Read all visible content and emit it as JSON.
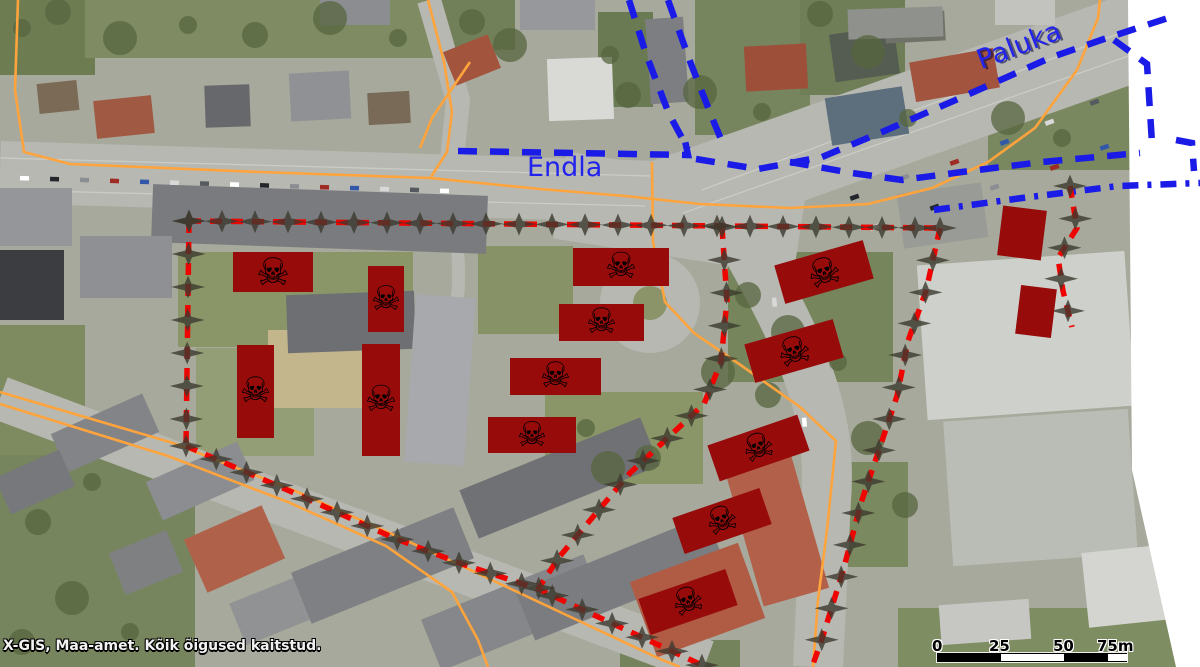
{
  "attribution": "X-GIS, Maa-amet. Kõik õigused kaitstud.",
  "street_labels": [
    {
      "id": "endla",
      "text": "Endla",
      "x": 527,
      "y": 152,
      "rotation": 0,
      "size": 27
    },
    {
      "id": "paluka",
      "text": "Paluka",
      "x": 978,
      "y": 46,
      "rotation": -21,
      "size": 27
    }
  ],
  "scale_bar": {
    "labels": [
      "0",
      "25",
      "50",
      "75m"
    ],
    "label_offsets": [
      -5,
      52,
      116,
      160
    ],
    "x": 937,
    "y": 637,
    "width": 190,
    "segments": [
      {
        "from": 0,
        "to": 63,
        "color": "#000000"
      },
      {
        "from": 63,
        "to": 126,
        "color": "#ffffff"
      },
      {
        "from": 126,
        "to": 170,
        "color": "#000000"
      },
      {
        "from": 170,
        "to": 190,
        "color": "#ffffff"
      }
    ]
  },
  "colors": {
    "hazard_fill": "#970b0b",
    "boundary_red": "#ee0400",
    "cadastre_blue": "#1b1be8",
    "road_orange": "#ffa43d",
    "star_marker": "#3c3a2e",
    "label_blue": "#2323ee",
    "no_imagery": "#ffffff"
  },
  "icons": {
    "skull_glyph": "☠",
    "skull_name": "skull-crossbones-icon",
    "vertex_marker": "four-point-star"
  },
  "hazard_rects": [
    {
      "x": 233,
      "y": 252,
      "w": 80,
      "h": 40,
      "rotation": 0,
      "skull": true
    },
    {
      "x": 368,
      "y": 266,
      "w": 36,
      "h": 66,
      "rotation": 0,
      "skull": true
    },
    {
      "x": 237,
      "y": 345,
      "w": 37,
      "h": 93,
      "rotation": 0,
      "skull": true
    },
    {
      "x": 362,
      "y": 344,
      "w": 38,
      "h": 112,
      "rotation": 0,
      "skull": true
    },
    {
      "x": 573,
      "y": 248,
      "w": 96,
      "h": 38,
      "rotation": 0,
      "skull": true
    },
    {
      "x": 559,
      "y": 304,
      "w": 85,
      "h": 37,
      "rotation": 0,
      "skull": true
    },
    {
      "x": 510,
      "y": 358,
      "w": 91,
      "h": 37,
      "rotation": 0,
      "skull": true
    },
    {
      "x": 488,
      "y": 417,
      "w": 88,
      "h": 36,
      "rotation": 0,
      "skull": true
    },
    {
      "x": 778,
      "y": 252,
      "w": 92,
      "h": 40,
      "rotation": -16,
      "skull": true
    },
    {
      "x": 748,
      "y": 331,
      "w": 92,
      "h": 40,
      "rotation": -16,
      "skull": true
    },
    {
      "x": 711,
      "y": 429,
      "w": 95,
      "h": 38,
      "rotation": -19,
      "skull": true
    },
    {
      "x": 676,
      "y": 502,
      "w": 92,
      "h": 38,
      "rotation": -19,
      "skull": true
    },
    {
      "x": 642,
      "y": 583,
      "w": 92,
      "h": 38,
      "rotation": -19,
      "skull": true
    },
    {
      "x": 1000,
      "y": 208,
      "w": 44,
      "h": 50,
      "rotation": 7,
      "skull": false
    },
    {
      "x": 1018,
      "y": 287,
      "w": 36,
      "h": 49,
      "rotation": 7,
      "skull": false
    }
  ],
  "red_lines": [
    {
      "points": [
        [
          189,
          221
        ],
        [
          940,
          228
        ]
      ]
    },
    {
      "points": [
        [
          189,
          221
        ],
        [
          186,
          446
        ]
      ]
    },
    {
      "points": [
        [
          186,
          446
        ],
        [
          292,
          492
        ],
        [
          394,
          538
        ],
        [
          462,
          564
        ],
        [
          538,
          589
        ],
        [
          622,
          628
        ],
        [
          706,
          667
        ]
      ]
    },
    {
      "points": [
        [
          940,
          228
        ],
        [
          926,
          291
        ],
        [
          908,
          341
        ],
        [
          897,
          396
        ],
        [
          882,
          441
        ],
        [
          861,
          503
        ],
        [
          843,
          571
        ],
        [
          822,
          639
        ],
        [
          812,
          667
        ]
      ]
    },
    {
      "points": [
        [
          722,
          227
        ],
        [
          727,
          300
        ],
        [
          721,
          362
        ],
        [
          704,
          404
        ],
        [
          630,
          473
        ],
        [
          560,
          556
        ],
        [
          538,
          589
        ]
      ]
    },
    {
      "points": [
        [
          1070,
          186
        ],
        [
          1077,
          228
        ],
        [
          1058,
          258
        ],
        [
          1063,
          291
        ],
        [
          1072,
          327
        ]
      ]
    }
  ],
  "blue_lines": [
    {
      "style": "dash",
      "points": [
        [
          458,
          151
        ],
        [
          688,
          155
        ],
        [
          684,
          136
        ]
      ]
    },
    {
      "style": "dash",
      "points": [
        [
          629,
          0
        ],
        [
          646,
          54
        ],
        [
          669,
          114
        ],
        [
          688,
          149
        ]
      ]
    },
    {
      "style": "dash",
      "points": [
        [
          668,
          0
        ],
        [
          691,
          64
        ],
        [
          713,
          120
        ],
        [
          723,
          144
        ]
      ]
    },
    {
      "style": "dash",
      "points": [
        [
          696,
          159
        ],
        [
          758,
          169
        ],
        [
          822,
          157
        ],
        [
          882,
          132
        ],
        [
          958,
          99
        ],
        [
          1052,
          57
        ],
        [
          1104,
          39
        ],
        [
          1168,
          18
        ]
      ]
    },
    {
      "style": "dash",
      "points": [
        [
          790,
          162
        ],
        [
          852,
          173
        ],
        [
          902,
          180
        ],
        [
          962,
          172
        ],
        [
          1042,
          162
        ],
        [
          1140,
          153
        ]
      ]
    },
    {
      "style": "dashdot",
      "points": [
        [
          934,
          210
        ],
        [
          1022,
          198
        ],
        [
          1118,
          186
        ],
        [
          1200,
          183
        ]
      ]
    },
    {
      "style": "dash",
      "points": [
        [
          1114,
          40
        ],
        [
          1147,
          64
        ],
        [
          1152,
          143
        ]
      ]
    },
    {
      "style": "dash",
      "points": [
        [
          1176,
          140
        ],
        [
          1192,
          143
        ],
        [
          1194,
          171
        ]
      ]
    }
  ],
  "orange_lines": [
    {
      "points": [
        [
          18,
          0
        ],
        [
          15,
          90
        ],
        [
          24,
          152
        ],
        [
          70,
          164
        ],
        [
          260,
          172
        ],
        [
          430,
          178
        ],
        [
          540,
          189
        ],
        [
          625,
          196
        ],
        [
          700,
          204
        ],
        [
          790,
          208
        ],
        [
          868,
          204
        ],
        [
          932,
          188
        ],
        [
          988,
          162
        ],
        [
          1035,
          128
        ],
        [
          1077,
          70
        ],
        [
          1098,
          18
        ],
        [
          1100,
          0
        ]
      ]
    },
    {
      "points": [
        [
          652,
          162
        ],
        [
          653,
          242
        ],
        [
          665,
          302
        ],
        [
          694,
          333
        ],
        [
          742,
          366
        ],
        [
          800,
          407
        ],
        [
          836,
          441
        ],
        [
          827,
          530
        ],
        [
          818,
          600
        ],
        [
          813,
          667
        ]
      ]
    },
    {
      "points": [
        [
          428,
          0
        ],
        [
          444,
          62
        ],
        [
          452,
          112
        ],
        [
          447,
          152
        ],
        [
          431,
          177
        ]
      ]
    },
    {
      "points": [
        [
          470,
          62
        ],
        [
          432,
          118
        ],
        [
          420,
          148
        ]
      ]
    },
    {
      "points": [
        [
          0,
          392
        ],
        [
          173,
          443
        ],
        [
          293,
          490
        ],
        [
          392,
          534
        ],
        [
          462,
          566
        ],
        [
          560,
          612
        ],
        [
          660,
          659
        ],
        [
          680,
          667
        ]
      ]
    },
    {
      "points": [
        [
          0,
          404
        ],
        [
          168,
          456
        ],
        [
          288,
          502
        ],
        [
          386,
          546
        ],
        [
          452,
          592
        ],
        [
          478,
          640
        ],
        [
          488,
          667
        ]
      ]
    }
  ]
}
